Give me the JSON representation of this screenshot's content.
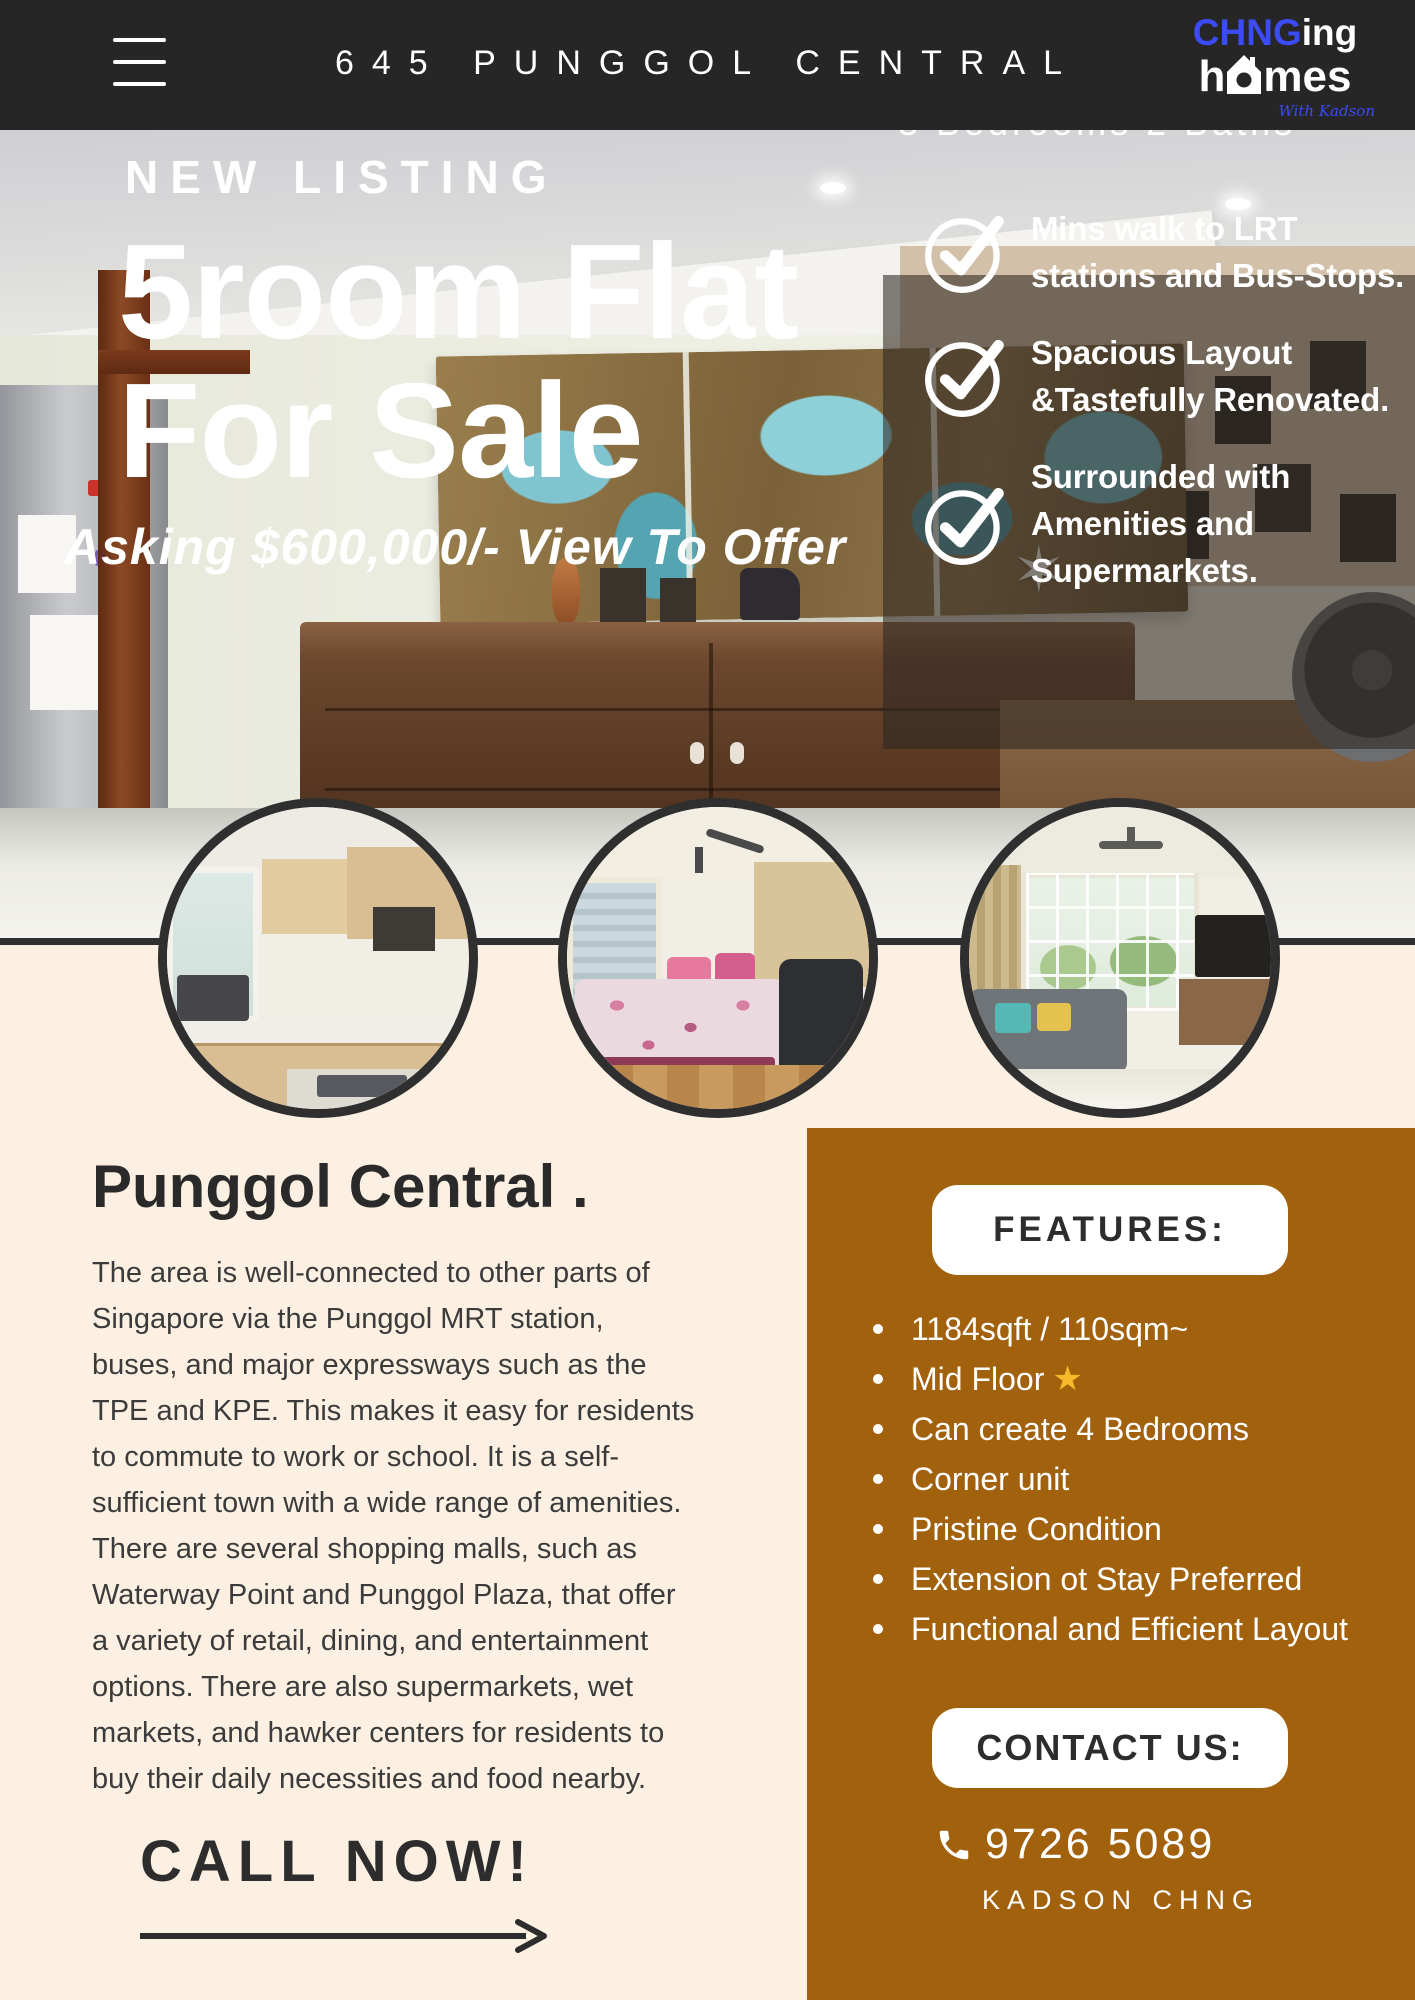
{
  "header": {
    "title": "645 PUNGGOL CENTRAL",
    "logo": {
      "chng": "CHNG",
      "ing": "ing",
      "h": "h",
      "mes": "mes",
      "tagline": "With Kadson"
    }
  },
  "hero": {
    "beds_baths": "3 Bedrooms 2 Baths",
    "eyebrow": "NEW LISTING",
    "headline_line1": "5room Flat",
    "headline_line2": "For Sale",
    "asking": "Asking $600,000/- View To Offer",
    "checklist": [
      {
        "lines": [
          "Mins walk to LRT",
          "stations and Bus-Stops."
        ]
      },
      {
        "lines": [
          "Spacious Layout",
          "&Tastefully Renovated."
        ]
      },
      {
        "lines": [
          "Surrounded with",
          "Amenities and",
          "Supermarkets."
        ]
      }
    ]
  },
  "about": {
    "heading": "Punggol Central .",
    "body": "The area is well-connected to other parts of Singapore via the Punggol MRT station, buses, and major expressways such as the TPE and KPE. This makes it easy for residents to commute to work or school. It is a self-sufficient town with a wide range of amenities. There are several shopping malls, such as Waterway Point and Punggol Plaza, that offer a variety of retail, dining, and entertainment options. There are also supermarkets, wet markets, and hawker centers for residents to buy their daily necessities and food nearby."
  },
  "cta": {
    "call_now": "CALL NOW!"
  },
  "features": {
    "title": "FEATURES:",
    "items": [
      {
        "text": "1184sqft / 110sqm~"
      },
      {
        "text": "Mid Floor"
      },
      {
        "text": "Can create 4 Bedrooms"
      },
      {
        "text": "Corner unit"
      },
      {
        "text": "Pristine Condition"
      },
      {
        "text": "Extension ot Stay Preferred"
      },
      {
        "text": "Functional and Efficient Layout"
      }
    ]
  },
  "contact": {
    "title": "CONTACT US:",
    "phone": "9726 5089",
    "agent": "KADSON CHNG"
  },
  "colors": {
    "header_bg": "#262626",
    "logo_blue": "#3B4BF6",
    "cream_bg": "#FCF0E2",
    "brown_bg": "#A2610D",
    "text_dark": "#2A2A2A",
    "white": "#FFFFFF",
    "star_gold": "#F7B928"
  }
}
